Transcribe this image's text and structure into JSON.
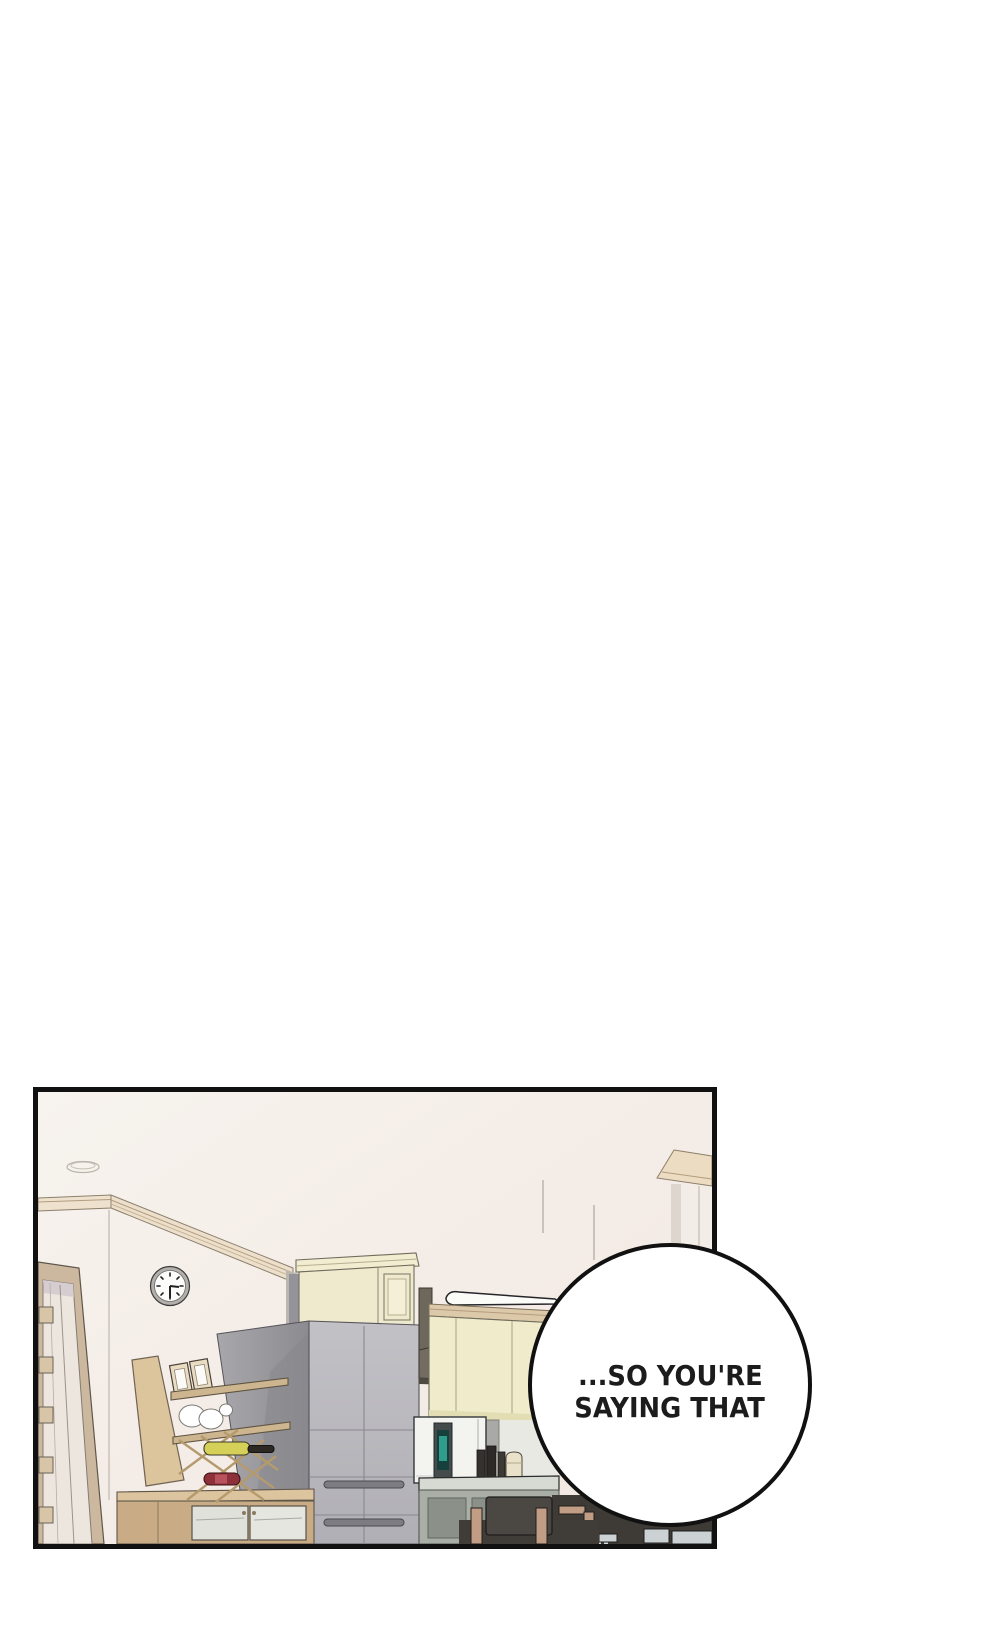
{
  "page": {
    "kind_label": "webtoon comic panel",
    "background": "#ffffff"
  },
  "panel": {
    "scene_label": "kitchen-interior",
    "border_color": "#111111",
    "wall_color": "#f5f0ea"
  },
  "speech_bubble": {
    "shape": "circle",
    "fill": "#ffffff",
    "stroke": "#111111",
    "text_color": "#1c1c1c",
    "line1": "...SO YOU'RE",
    "line2": "SAYING THAT"
  },
  "scene": {
    "clock_time": "3:30",
    "objects": [
      "ceiling-lamp",
      "crown-molding",
      "wall-clock",
      "door",
      "wine-rack-shelf",
      "picture-frames",
      "bowls",
      "wine-bottles",
      "sideboard-cabinet",
      "refrigerator",
      "above-fridge-cabinet",
      "range-hood",
      "upper-cabinets",
      "microwave-oven",
      "cutting-boards",
      "canister",
      "countertop",
      "lower-cabinets",
      "dining-chair",
      "dining-table",
      "right-wall-cornice"
    ],
    "palette": {
      "wall": "#f5f0ea",
      "molding": "#e9dcc6",
      "cream_cabinet": "#f0eccb",
      "fridge_front": "#bcbbc1",
      "fridge_side": "#9b9aa0",
      "wood": "#d9c29d",
      "hood": "#6d675c",
      "bottle_yellow": "#d5d158",
      "bottle_red": "#8e3039",
      "microwave_screen": "#2f9c8c",
      "chair": "#4b4742",
      "chair_leg": "#c29d85",
      "counter": "#d7d9d3"
    }
  }
}
